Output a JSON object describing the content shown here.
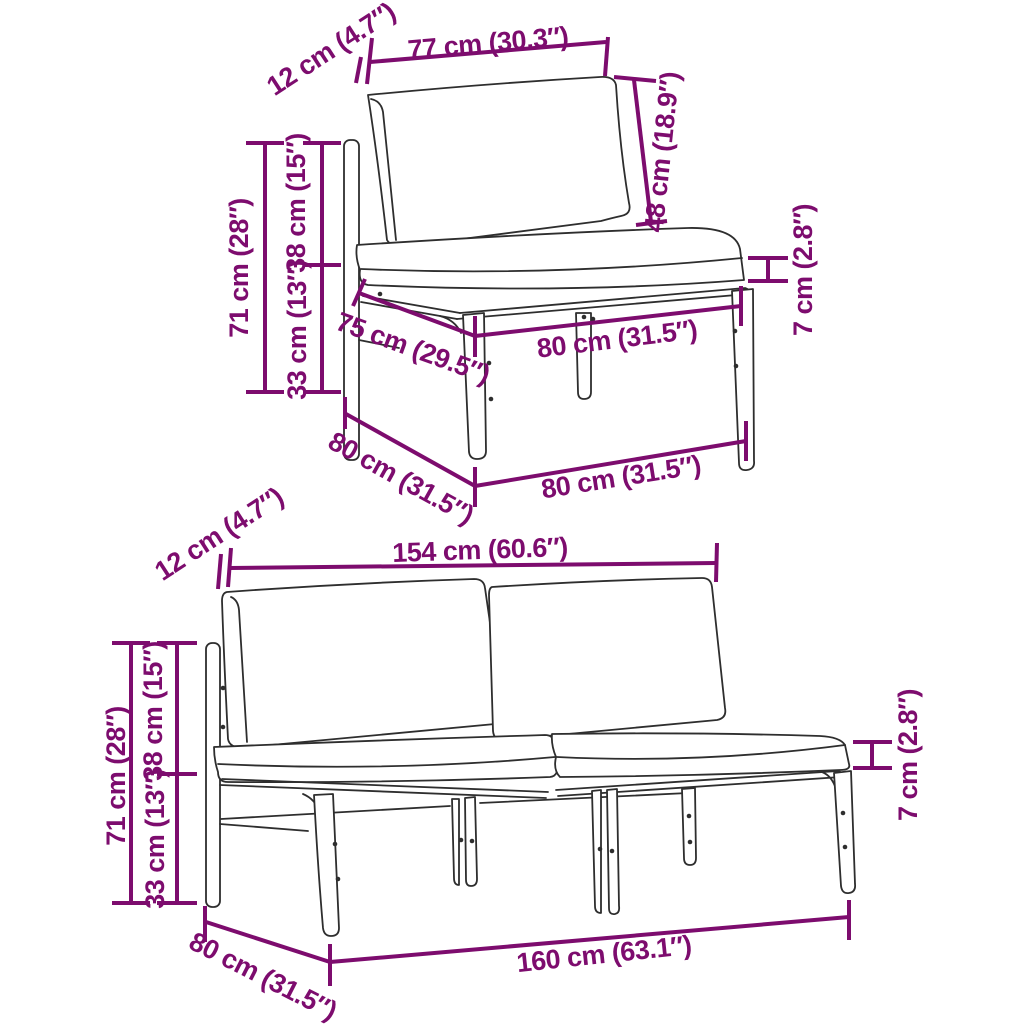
{
  "colors": {
    "dimension": "#7D0C6E",
    "line_art": "#2E2E2E",
    "background": "#FFFFFF"
  },
  "product": {
    "top_view": {
      "name": "single-seat-module",
      "dims": {
        "frame_offset": "12 cm (4.7″)",
        "back_width": "77 cm (30.3″)",
        "back_height": "48 cm (18.9″)",
        "height": "71 cm (28″)",
        "backrest_height": "38 cm (15″)",
        "seat_height": "33 cm (13″)",
        "seat_depth": "75 cm (29.5″)",
        "seat_width": "80 cm (31.5″)",
        "cushion_thickness": "7 cm (2.8″)",
        "depth": "80 cm (31.5″)",
        "width": "80 cm (31.5″)"
      }
    },
    "bottom_view": {
      "name": "two-seat-bench",
      "dims": {
        "frame_offset": "12 cm (4.7″)",
        "back_width": "154 cm (60.6″)",
        "height": "71 cm (28″)",
        "backrest_height": "38 cm (15″)",
        "seat_height": "33 cm (13″)",
        "cushion_thickness": "7 cm (2.8″)",
        "depth": "80 cm (31.5″)",
        "width": "160 cm (63.1″)"
      }
    }
  }
}
